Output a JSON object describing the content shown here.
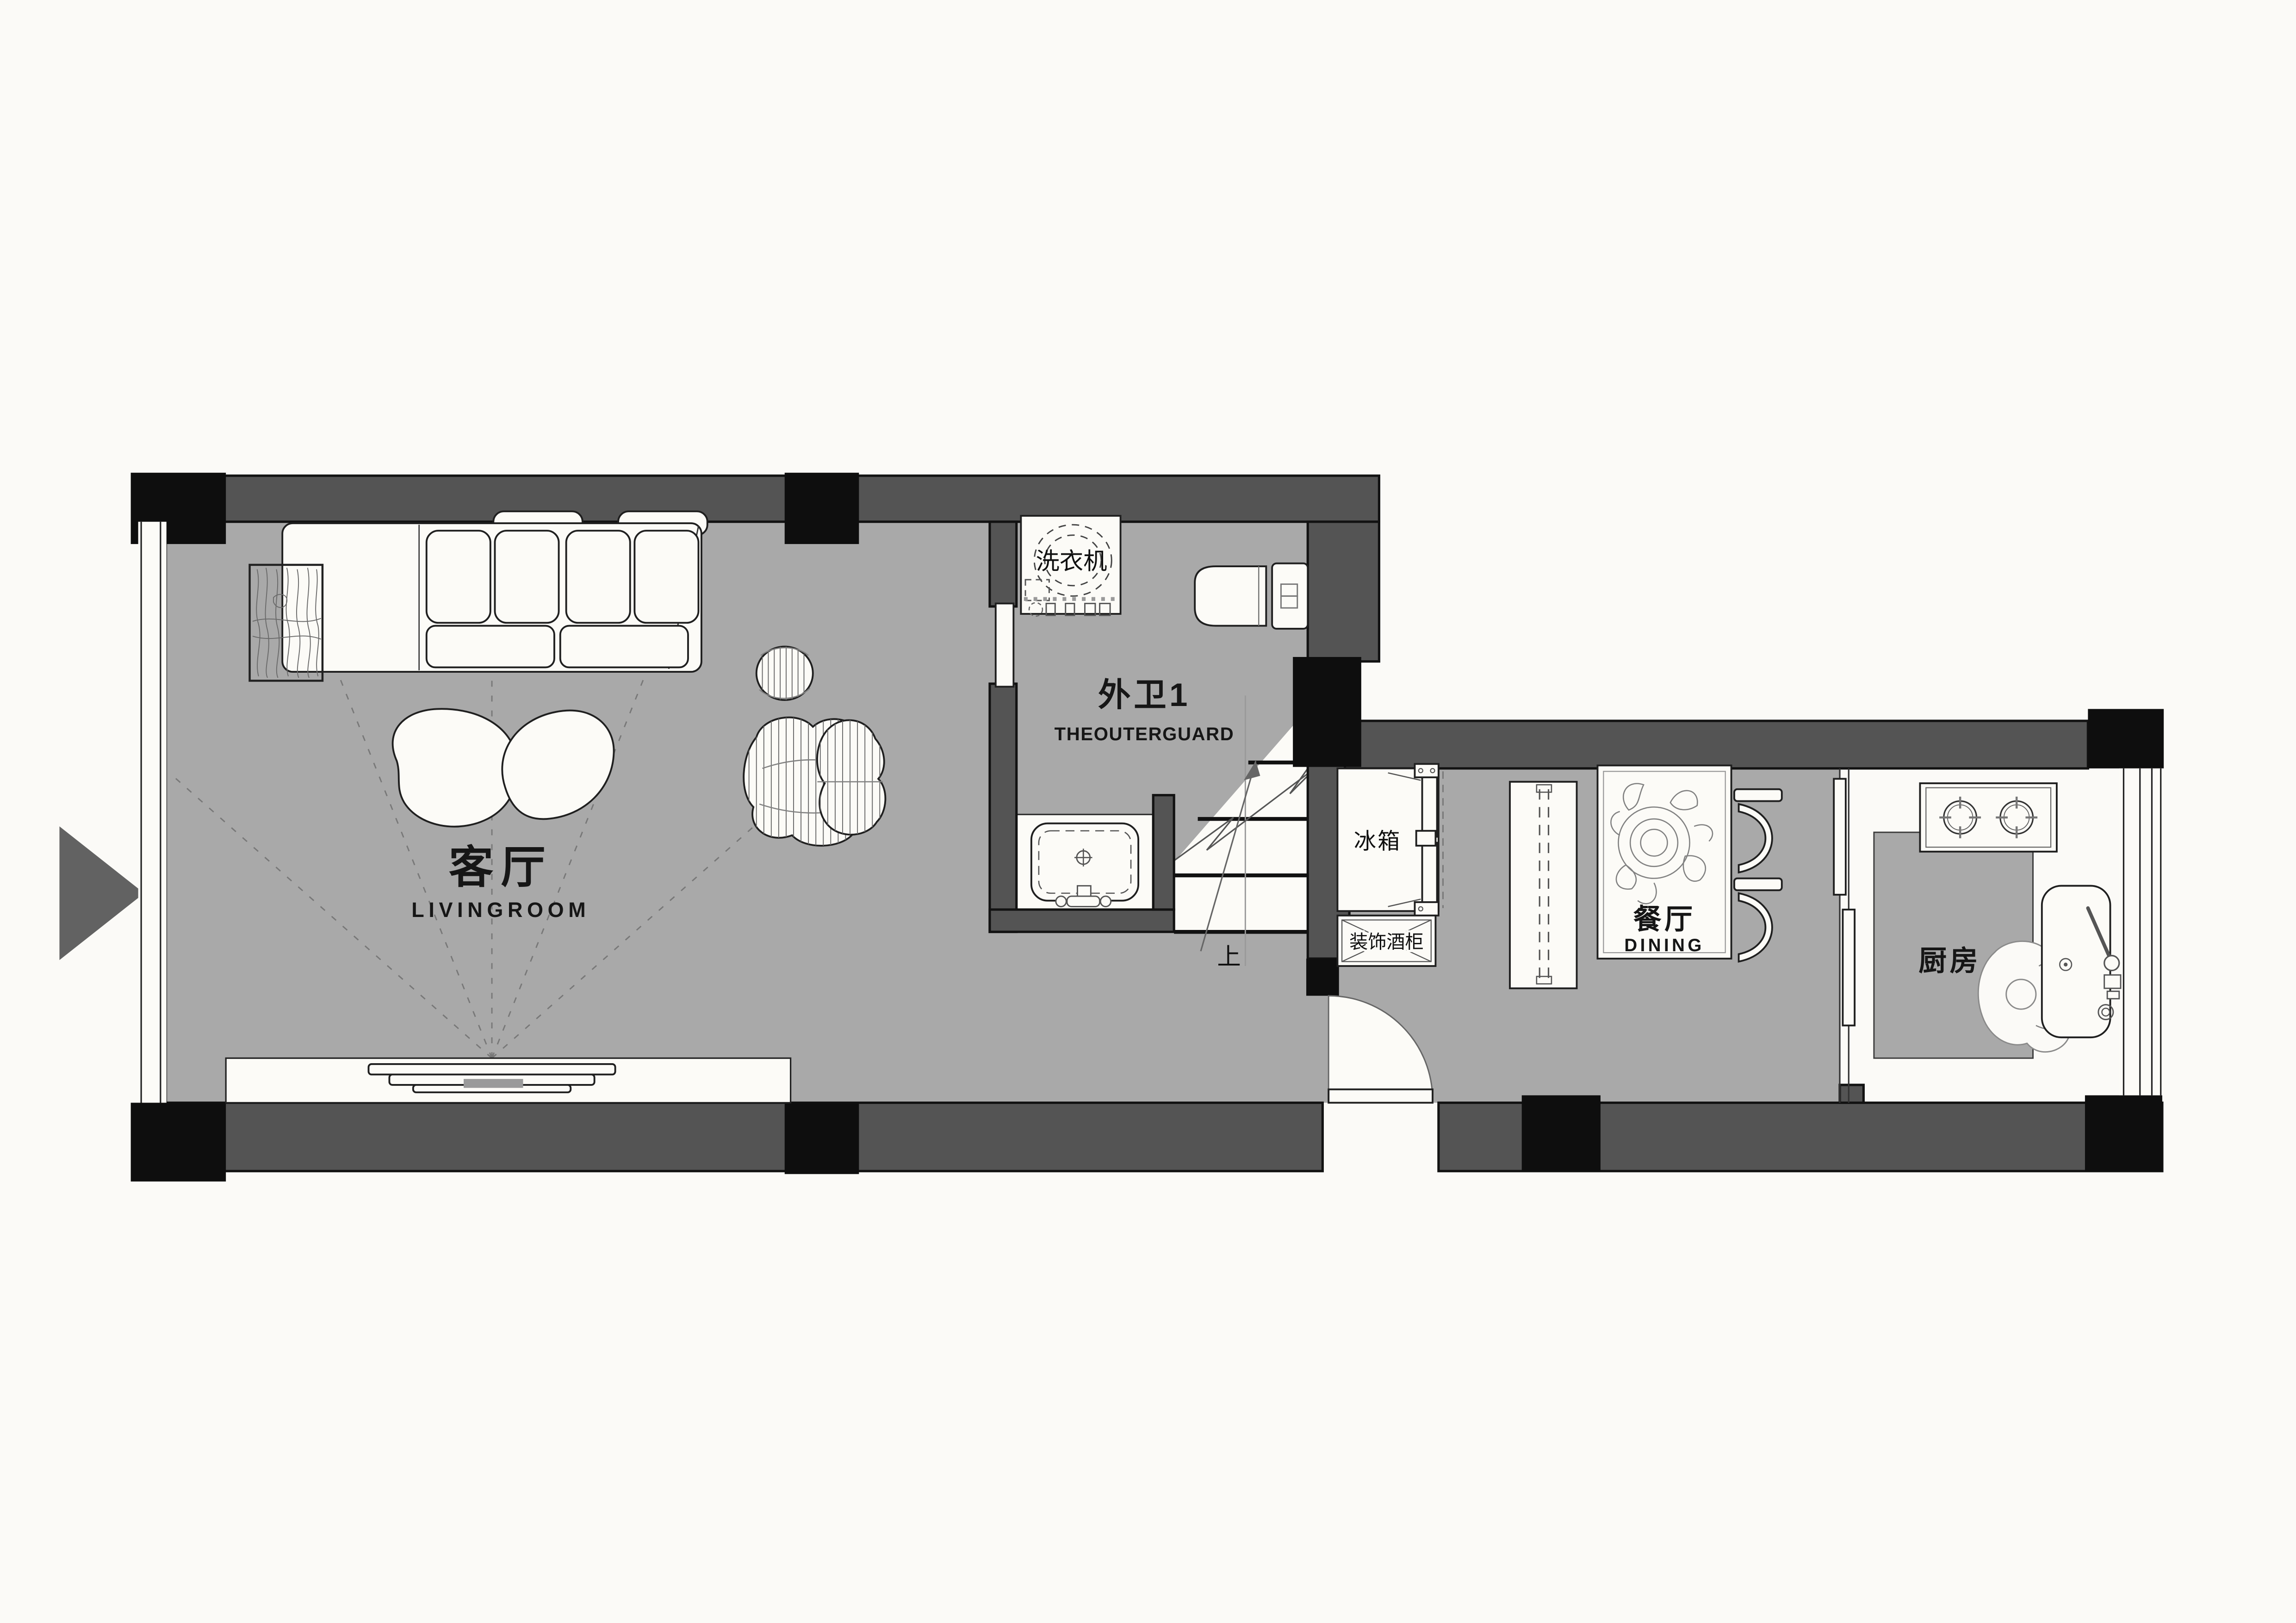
{
  "colors": {
    "background": "#fbfaf7",
    "floor": "#a9a9a9",
    "wall": "#545454",
    "column": "#0e0e0e",
    "furniture": "#fcfbf7",
    "ink": "#161616",
    "marker": "#626262"
  },
  "rooms": {
    "living": {
      "zh": "客厅",
      "en": "LIVINGROOM"
    },
    "outerguard": {
      "zh": "外卫1",
      "en": "THEOUTERGUARD"
    },
    "dining": {
      "zh": "餐厅",
      "en": "DINING"
    },
    "kitchen": {
      "zh": "厨房"
    }
  },
  "fixtures": {
    "washer": "洗衣机",
    "fridge": "冰箱",
    "wineCabinet": "装饰酒柜",
    "stairsUp": "上"
  }
}
